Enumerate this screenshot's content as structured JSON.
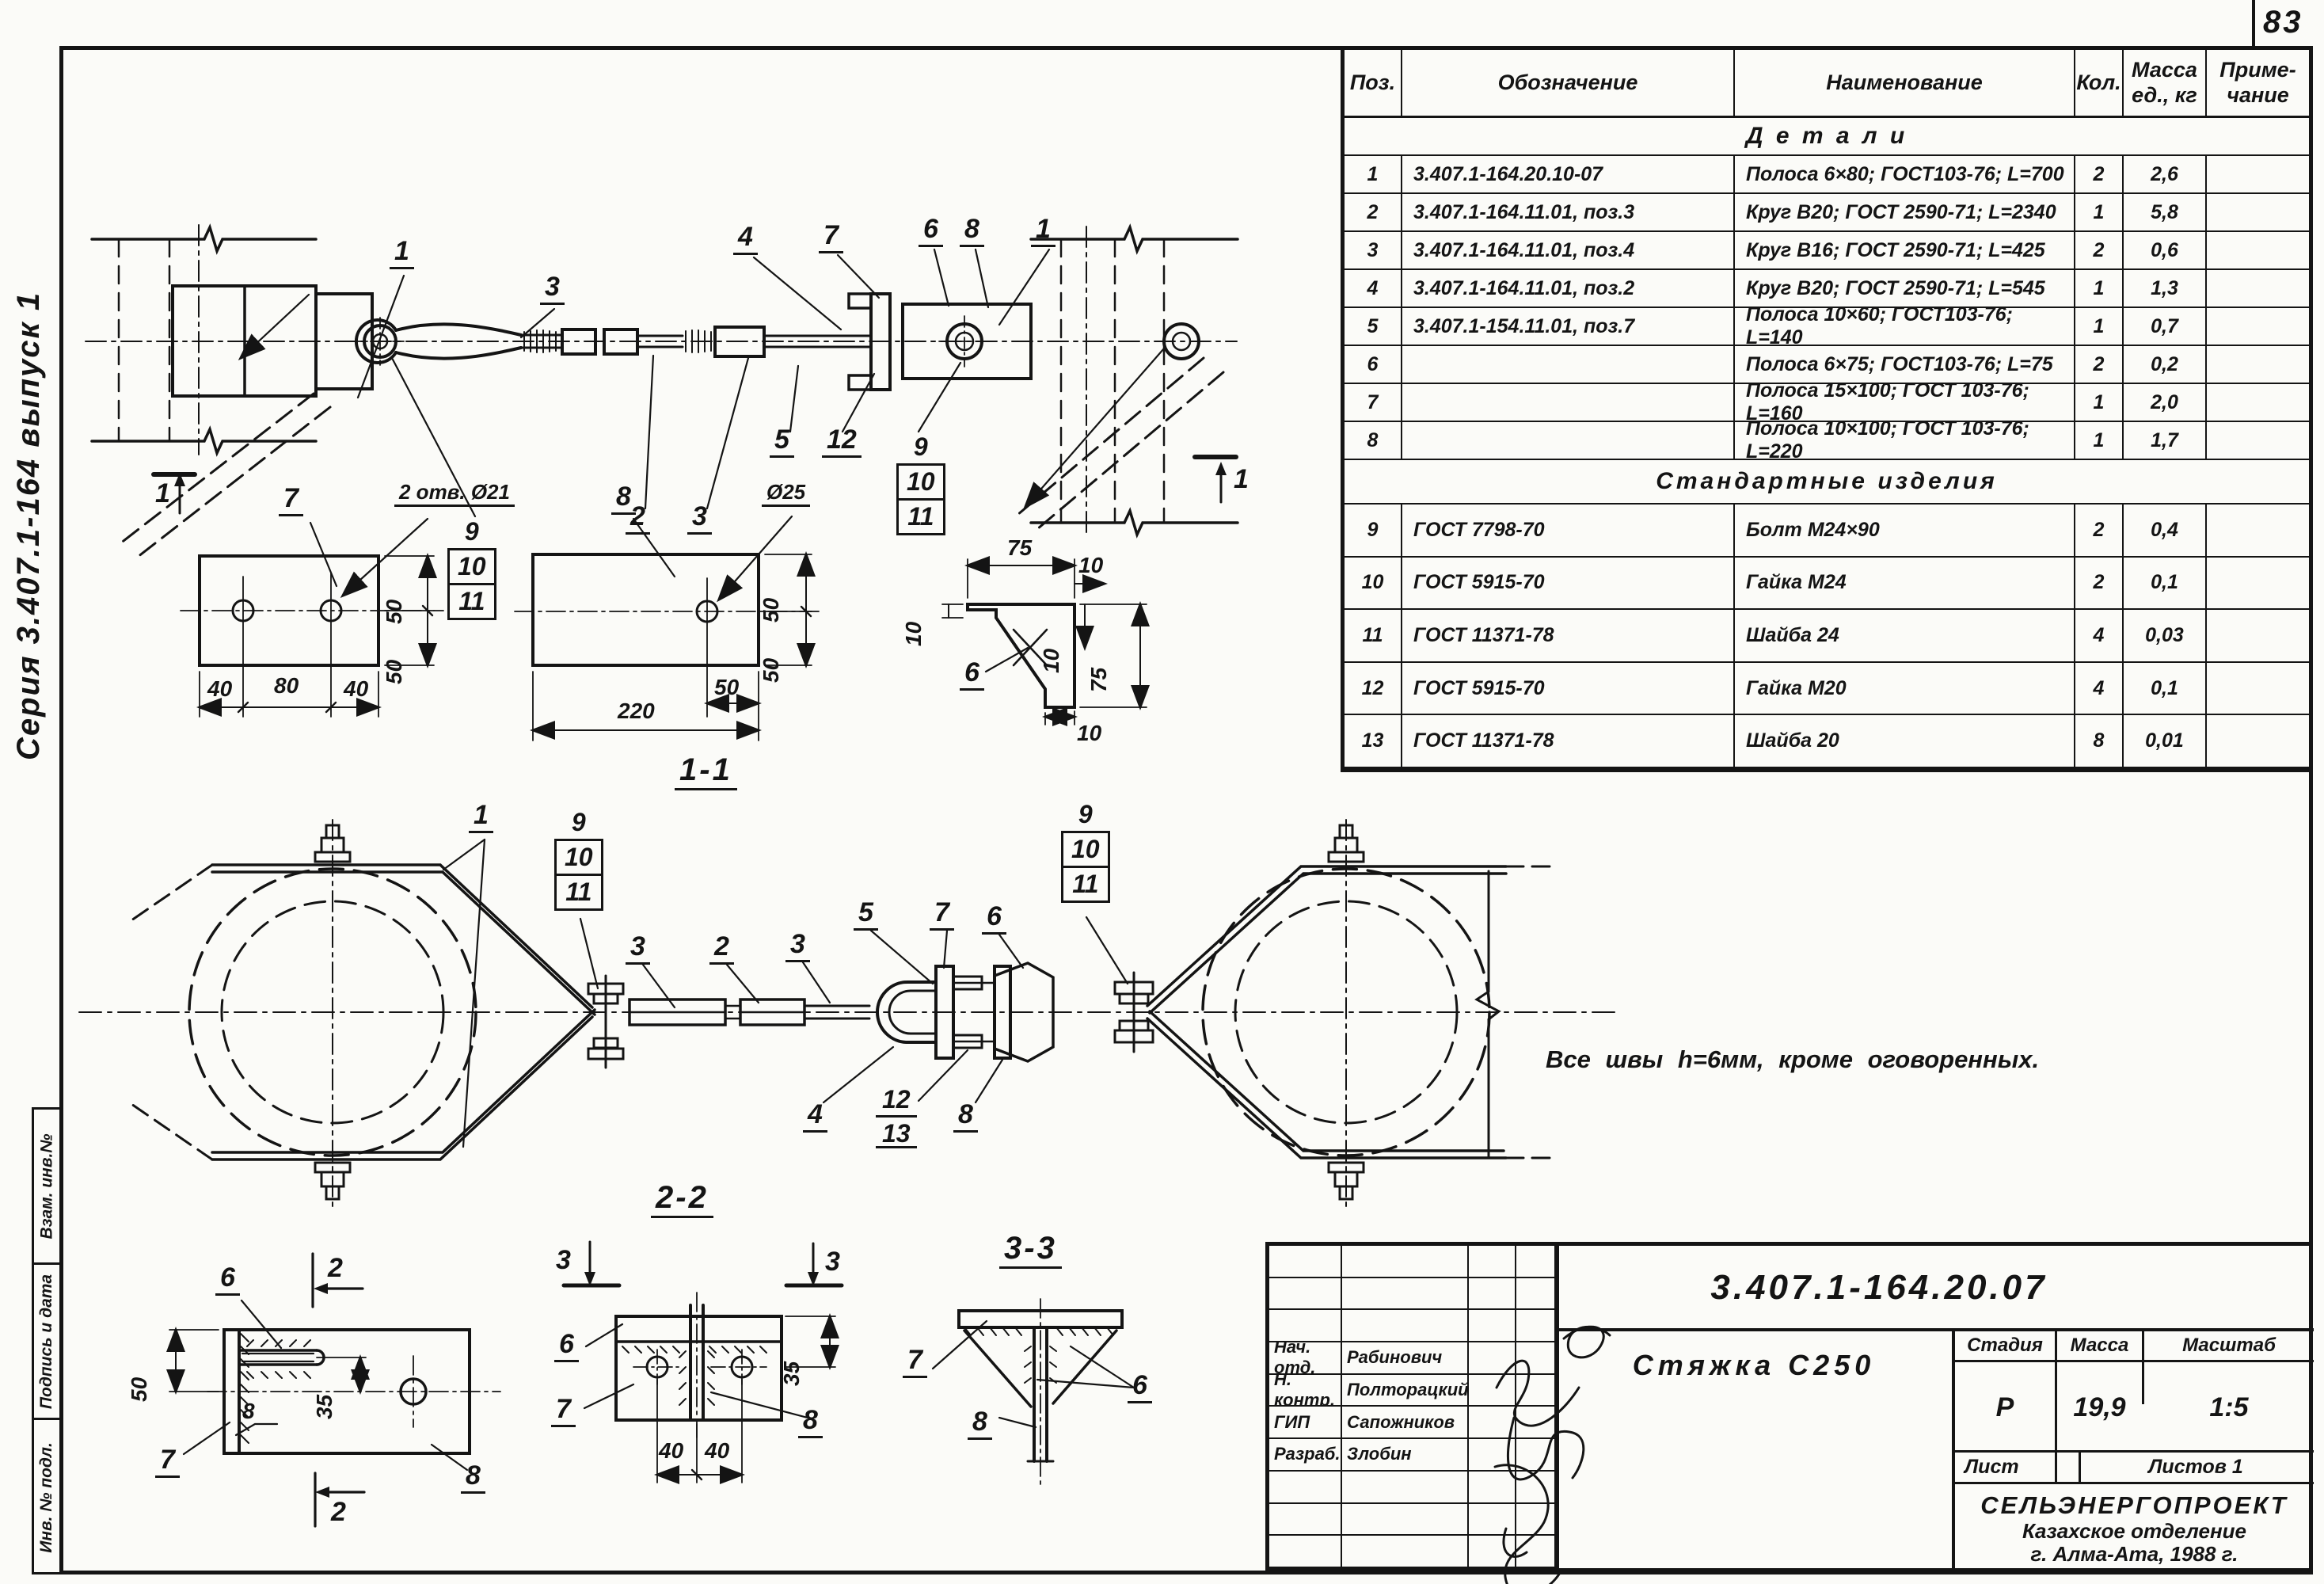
{
  "page": {
    "sheet_number": "83",
    "series": "Серия 3.407.1-164 выпуск 1",
    "note": "Все  швы  h=6мм,  кроме  оговоренных.",
    "side_stamps": [
      "Взам. инв.№",
      "Подпись и дата",
      "Инв. № подл."
    ]
  },
  "labels": {
    "n1": "1",
    "n2": "2",
    "n3": "3",
    "n4": "4",
    "n5": "5",
    "n6": "6",
    "n7": "7",
    "n8": "8",
    "n9": "9",
    "n10": "10",
    "n11": "11",
    "n12": "12",
    "n13": "13",
    "d10": "10",
    "d35": "35",
    "d40": "40",
    "d50": "50",
    "d75": "75",
    "d80": "80",
    "d220": "220",
    "holes7": "2 отв. Ø21",
    "hole25": "Ø25",
    "s11": "1-1",
    "s22": "2-2",
    "s33": "3-3"
  },
  "parts_table": {
    "col_pos": "Поз.",
    "col_designation": "Обозначение",
    "col_name": "Наименование",
    "col_qty": "Кол.",
    "col_mass1": "Масса",
    "col_mass2": "ед., кг",
    "col_note1": "Приме-",
    "col_note2": "чание",
    "section_details": "Д е т а л и",
    "section_standard": "Стандартные  изделия",
    "rows": [
      {
        "pos": "1",
        "designation": "3.407.1-164.20.10-07",
        "name": "Полоса 6×80; ГОСТ103-76; L=700",
        "qty": "2",
        "mass": "2,6"
      },
      {
        "pos": "2",
        "designation": "3.407.1-164.11.01, поз.3",
        "name": "Круг В20; ГОСТ 2590-71; L=2340",
        "qty": "1",
        "mass": "5,8"
      },
      {
        "pos": "3",
        "designation": "3.407.1-164.11.01, поз.4",
        "name": "Круг В16; ГОСТ 2590-71; L=425",
        "qty": "2",
        "mass": "0,6"
      },
      {
        "pos": "4",
        "designation": "3.407.1-164.11.01, поз.2",
        "name": "Круг В20; ГОСТ 2590-71; L=545",
        "qty": "1",
        "mass": "1,3"
      },
      {
        "pos": "5",
        "designation": "3.407.1-154.11.01, поз.7",
        "name": "Полоса 10×60; ГОСТ103-76; L=140",
        "qty": "1",
        "mass": "0,7"
      },
      {
        "pos": "6",
        "designation": "",
        "name": "Полоса 6×75; ГОСТ103-76; L=75",
        "qty": "2",
        "mass": "0,2"
      },
      {
        "pos": "7",
        "designation": "",
        "name": "Полоса 15×100; ГОСТ 103-76; L=160",
        "qty": "1",
        "mass": "2,0"
      },
      {
        "pos": "8",
        "designation": "",
        "name": "Полоса 10×100; ГОСТ 103-76; L=220",
        "qty": "1",
        "mass": "1,7"
      },
      {
        "pos": "9",
        "designation": "ГОСТ 7798-70",
        "name": "Болт М24×90",
        "qty": "2",
        "mass": "0,4"
      },
      {
        "pos": "10",
        "designation": "ГОСТ 5915-70",
        "name": "Гайка М24",
        "qty": "2",
        "mass": "0,1"
      },
      {
        "pos": "11",
        "designation": "ГОСТ 11371-78",
        "name": "Шайба 24",
        "qty": "4",
        "mass": "0,03"
      },
      {
        "pos": "12",
        "designation": "ГОСТ 5915-70",
        "name": "Гайка М20",
        "qty": "4",
        "mass": "0,1"
      },
      {
        "pos": "13",
        "designation": "ГОСТ 11371-78",
        "name": "Шайба 20",
        "qty": "8",
        "mass": "0,01"
      }
    ]
  },
  "title_block": {
    "doc_number": "3.407.1-164.20.07",
    "product_name": "Стяжка  С250",
    "stage_label": "Стадия",
    "mass_label": "Масса",
    "scale_label": "Масштаб",
    "stage": "Р",
    "mass": "19,9",
    "scale": "1:5",
    "sheet_label": "Лист",
    "sheets_label": "Листов  1",
    "org_name": "СЕЛЬЭНЕРГОПРОЕКТ",
    "org_branch": "Казахское отделение",
    "org_city": "г. Алма-Ата, 1988 г.",
    "signers": [
      {
        "role": "Нач. отд.",
        "name": "Рабинович"
      },
      {
        "role": "Н. контр.",
        "name": "Полторацкий"
      },
      {
        "role": "ГИП",
        "name": "Сапожников"
      },
      {
        "role": "Разраб.",
        "name": "Злобин"
      }
    ]
  }
}
